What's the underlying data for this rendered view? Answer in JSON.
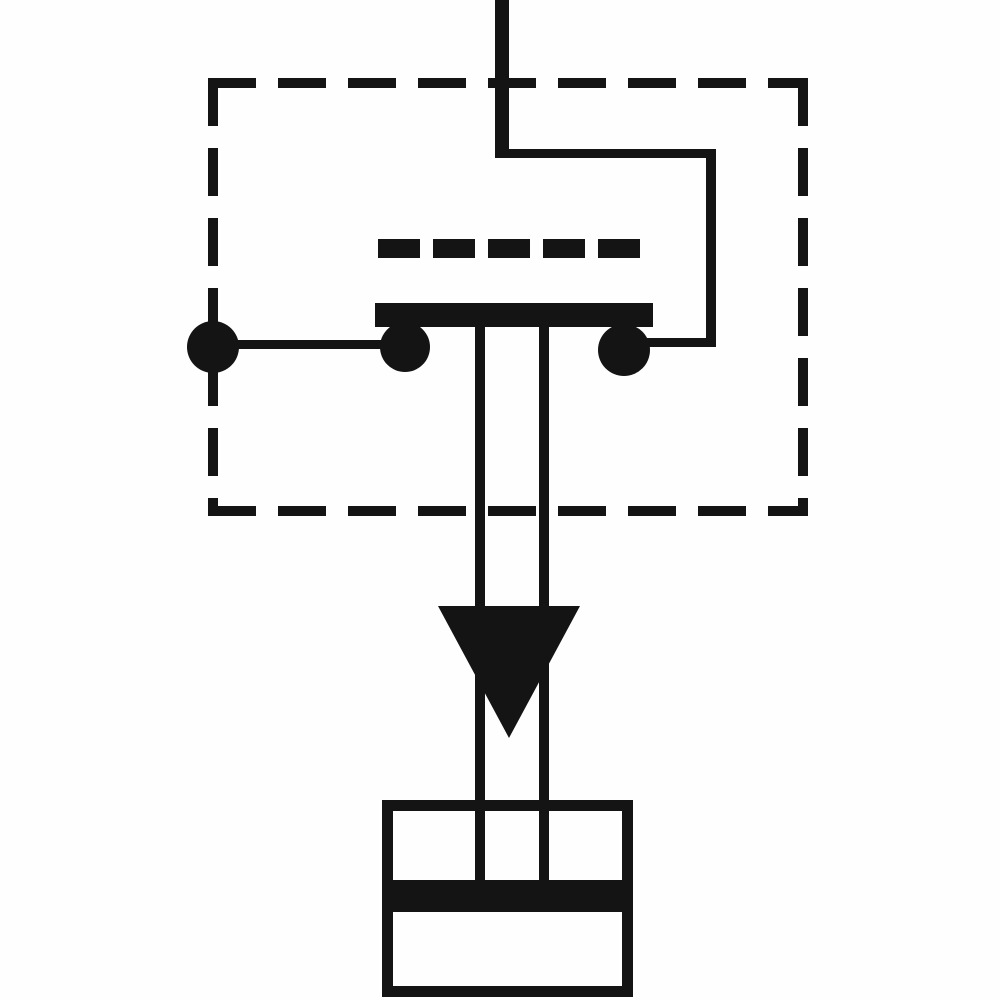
{
  "canvas": {
    "width": 1000,
    "height": 1000,
    "background": "#fefefe",
    "ink": "#141414"
  },
  "diagram": {
    "kind": "pressure-switch-schematic",
    "description": "scanned schematic symbol of a pressure switch: dashed enclosure with contact bridge and terminals, plunger stem with downward pressure arrow, piston chamber at bottom",
    "elements": [
      {
        "name": "enclosure-dashed-box",
        "type": "dashed-rect",
        "x": 208,
        "y": 78,
        "w": 600,
        "h": 438,
        "stroke": 10,
        "dash": 48,
        "gap": 22
      },
      {
        "name": "contact-actuator-dashed-line",
        "type": "dashed-h-line",
        "x": 378,
        "y": 239,
        "w": 272,
        "h": 19,
        "dash": 42,
        "gap": 13
      },
      {
        "name": "supply-line-vertical",
        "type": "rect",
        "x": 495,
        "y": 0,
        "w": 14,
        "h": 158
      },
      {
        "name": "supply-wire-horizontal",
        "type": "rect",
        "x": 497,
        "y": 149,
        "w": 219,
        "h": 9
      },
      {
        "name": "right-drop-wire",
        "type": "rect",
        "x": 706,
        "y": 149,
        "w": 10,
        "h": 198
      },
      {
        "name": "right-contact-feed-wire",
        "type": "rect",
        "x": 640,
        "y": 338,
        "w": 76,
        "h": 9
      },
      {
        "name": "left-terminal-wire",
        "type": "rect",
        "x": 213,
        "y": 340,
        "w": 192,
        "h": 9
      },
      {
        "name": "plunger-stem-left",
        "type": "rect",
        "x": 475,
        "y": 326,
        "w": 10,
        "h": 556
      },
      {
        "name": "plunger-stem-right",
        "type": "rect",
        "x": 539,
        "y": 326,
        "w": 10,
        "h": 556
      },
      {
        "name": "contact-bridge-bar",
        "type": "rect",
        "x": 375,
        "y": 303,
        "w": 278,
        "h": 24
      },
      {
        "name": "left-terminal-dot",
        "type": "circle",
        "cx": 213,
        "cy": 347,
        "r": 26
      },
      {
        "name": "left-contact-dot",
        "type": "circle",
        "cx": 405,
        "cy": 347,
        "r": 25
      },
      {
        "name": "right-contact-dot",
        "type": "circle",
        "cx": 624,
        "cy": 350,
        "r": 26
      },
      {
        "name": "pressure-arrow",
        "type": "triangle-down",
        "x": 438,
        "y": 606,
        "w": 142,
        "h": 132
      },
      {
        "name": "pressure-chamber-box",
        "type": "outline-rect",
        "x": 382,
        "y": 800,
        "w": 251,
        "h": 197,
        "stroke": 11
      },
      {
        "name": "piston-band",
        "type": "rect",
        "x": 382,
        "y": 880,
        "w": 251,
        "h": 32
      }
    ]
  }
}
